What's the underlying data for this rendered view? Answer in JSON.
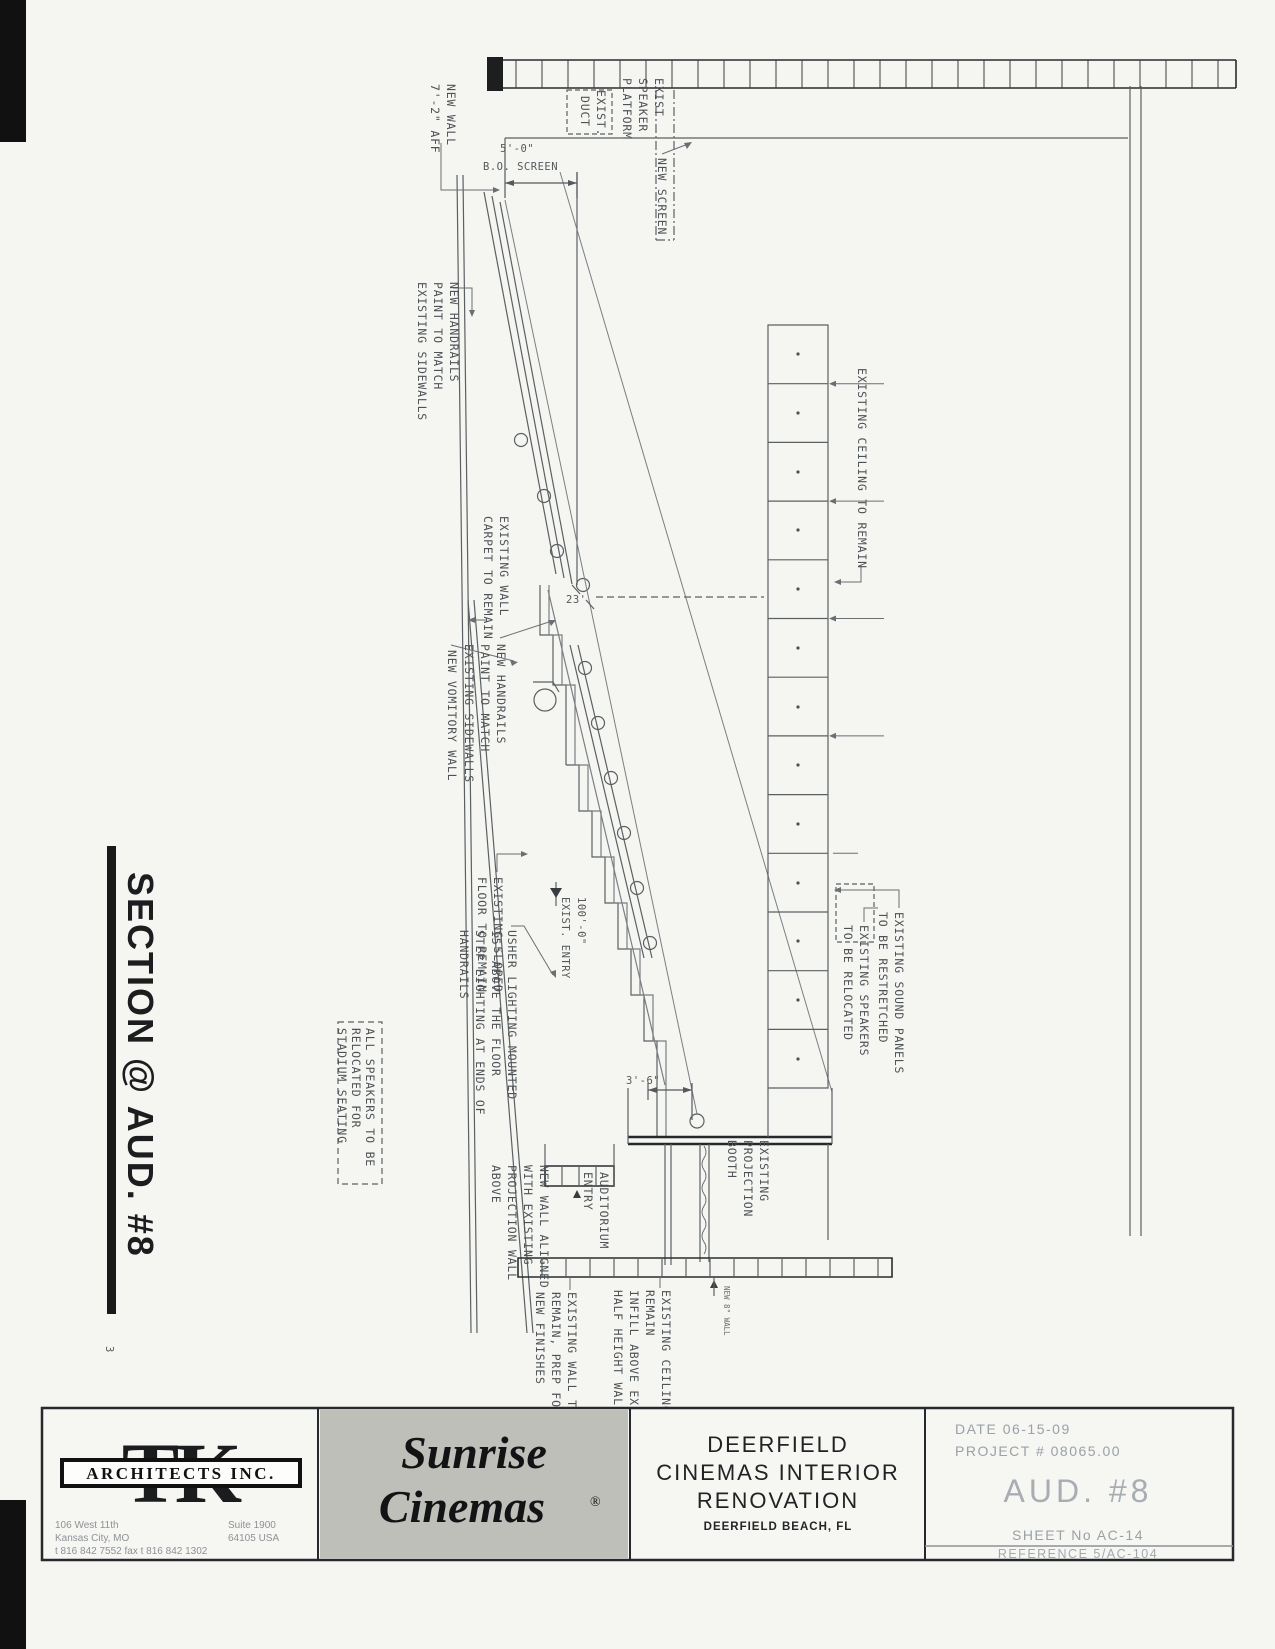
{
  "title": {
    "text": "SECTION @ AUD. #8",
    "detail_no": "3"
  },
  "a": {
    "newWallAff": {
      "l1": "NEW WALL",
      "l2": "7'-2\" AFF"
    },
    "existDuct": {
      "l1": "EXIST.",
      "l2": "DUCT"
    },
    "speakerPlatform": {
      "l1": "EXIST",
      "l2": "SPEAKER",
      "l3": "PLATFORM"
    },
    "newScreen": {
      "l1": "NEW SCREEN"
    },
    "handrails": {
      "l1": "NEW HANDRAILS",
      "l2": "PAINT TO MATCH",
      "l3": "EXISTING SIDEWALLS"
    },
    "wallCarpet": {
      "l1": "EXISTING WALL",
      "l2": "CARPET TO REMAIN"
    },
    "vomitory": {
      "l1": "NEW VOMITORY WALL"
    },
    "slopedFloor": {
      "l1": "EXISTING SLOPED",
      "l2": "FLOOR TO REMAIN"
    },
    "usher": {
      "l1": "USHER LIGHTING MOUNTED",
      "l2": "15\" ABOVE THE FLOOR",
      "l3": "STEP LIGHTING AT ENDS OF",
      "l4": "HANDRAILS"
    },
    "speakersNote": {
      "l1": "ALL SPEAKERS TO BE",
      "l2": "RELOCATED FOR",
      "l3": "STADIUM SEATING"
    },
    "ceilingRemain": {
      "l1": "EXISTING CEILING TO REMAIN"
    },
    "speakersReloc": {
      "l1": "EXISTING SPEAKERS",
      "l2": "TO BE RELOCATED"
    },
    "soundPanels": {
      "l1": "EXISTING SOUND PANELS",
      "l2": "TO BE RESTRETCHED"
    },
    "projBooth": {
      "l1": "EXISTING",
      "l2": "PROJECTION",
      "l3": "BOOTH"
    },
    "audEntry": {
      "l1": "AUDITORIUM",
      "l2": "ENTRY"
    },
    "newWallAligned": {
      "l1": "NEW WALL ALIGNED",
      "l2": "WITH EXISTING",
      "l3": "PROJECTION WALL",
      "l4": "ABOVE"
    },
    "wallRemain": {
      "l1": "EXISTING WALL TO",
      "l2": "REMAIN, PREP FOR",
      "l3": "NEW FINISHES"
    },
    "ceilingInfill": {
      "l1": "EXISTING CEILING TO",
      "l2": "REMAIN",
      "l3": "INFILL ABOVE EXISTING",
      "l4": "HALF HEIGHT WALL"
    },
    "tinyWall": {
      "l1": "NEW 8\" WALL"
    }
  },
  "d": {
    "bo1": "5'-0\"",
    "bo2": "B.O. SCREEN",
    "throw": "23'",
    "port": "3'-6\"",
    "elev": "100'-0\"",
    "elevName": "EXIST. ENTRY"
  },
  "titleblock": {
    "architect": {
      "logo": "TK",
      "banner": "ARCHITECTS INC.",
      "addr1": "106 West 11th",
      "addr2": "Suite 1900",
      "addr3": "Kansas City, MO",
      "addr4": "64105 USA",
      "addr5": "t 816 842 7552  fax t 816 842 1302"
    },
    "brand": {
      "line1": "Sunrise",
      "line2": "Cinemas",
      "reg": "®"
    },
    "project": {
      "line1": "DEERFIELD",
      "line2": "CINEMAS INTERIOR",
      "line3": "RENOVATION",
      "location": "DEERFIELD BEACH, FL"
    },
    "meta": {
      "date": "DATE 06-15-09",
      "project_no": "PROJECT # 08065.00",
      "aud": "AUD.  #8",
      "sheet": "SHEET No AC-14",
      "reference": "REFERENCE 5/AC-104"
    }
  }
}
